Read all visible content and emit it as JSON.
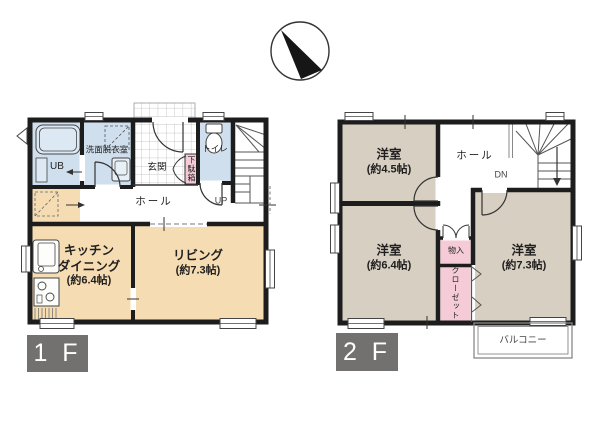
{
  "compass": {
    "icon": "north-arrow"
  },
  "colors": {
    "room_beige": "#f6dcb2",
    "room_taupe": "#d7cfc2",
    "wet_blue": "#cfdfee",
    "storage_pink": "#f5cbd7",
    "wall": "#1d1d1d",
    "floor_badge_gray": "#737070"
  },
  "floor1": {
    "badge": "1 F",
    "rooms": {
      "unit_bath": "UB",
      "washroom": "洗面脱衣室",
      "entrance": "玄関",
      "shoe_cabinet": "下駄箱",
      "toilet": "トイレ",
      "hall": "ホール",
      "stairs": "UP",
      "kitchen_name1": "キッチン",
      "kitchen_name2": "ダイニング",
      "kitchen_size": "(約6.4帖)",
      "living_name": "リビング",
      "living_size": "(約7.3帖)"
    }
  },
  "floor2": {
    "badge": "2 F",
    "rooms": {
      "bedroom_45_name": "洋室",
      "bedroom_45_size": "(約4.5帖)",
      "hall": "ホール",
      "stairs": "DN",
      "bedroom_64_name": "洋室",
      "bedroom_64_size": "(約6.4帖)",
      "bedroom_73_name": "洋室",
      "bedroom_73_size": "(約7.3帖)",
      "storage": "物入",
      "closet": "クローゼット",
      "balcony": "バルコニー"
    }
  }
}
